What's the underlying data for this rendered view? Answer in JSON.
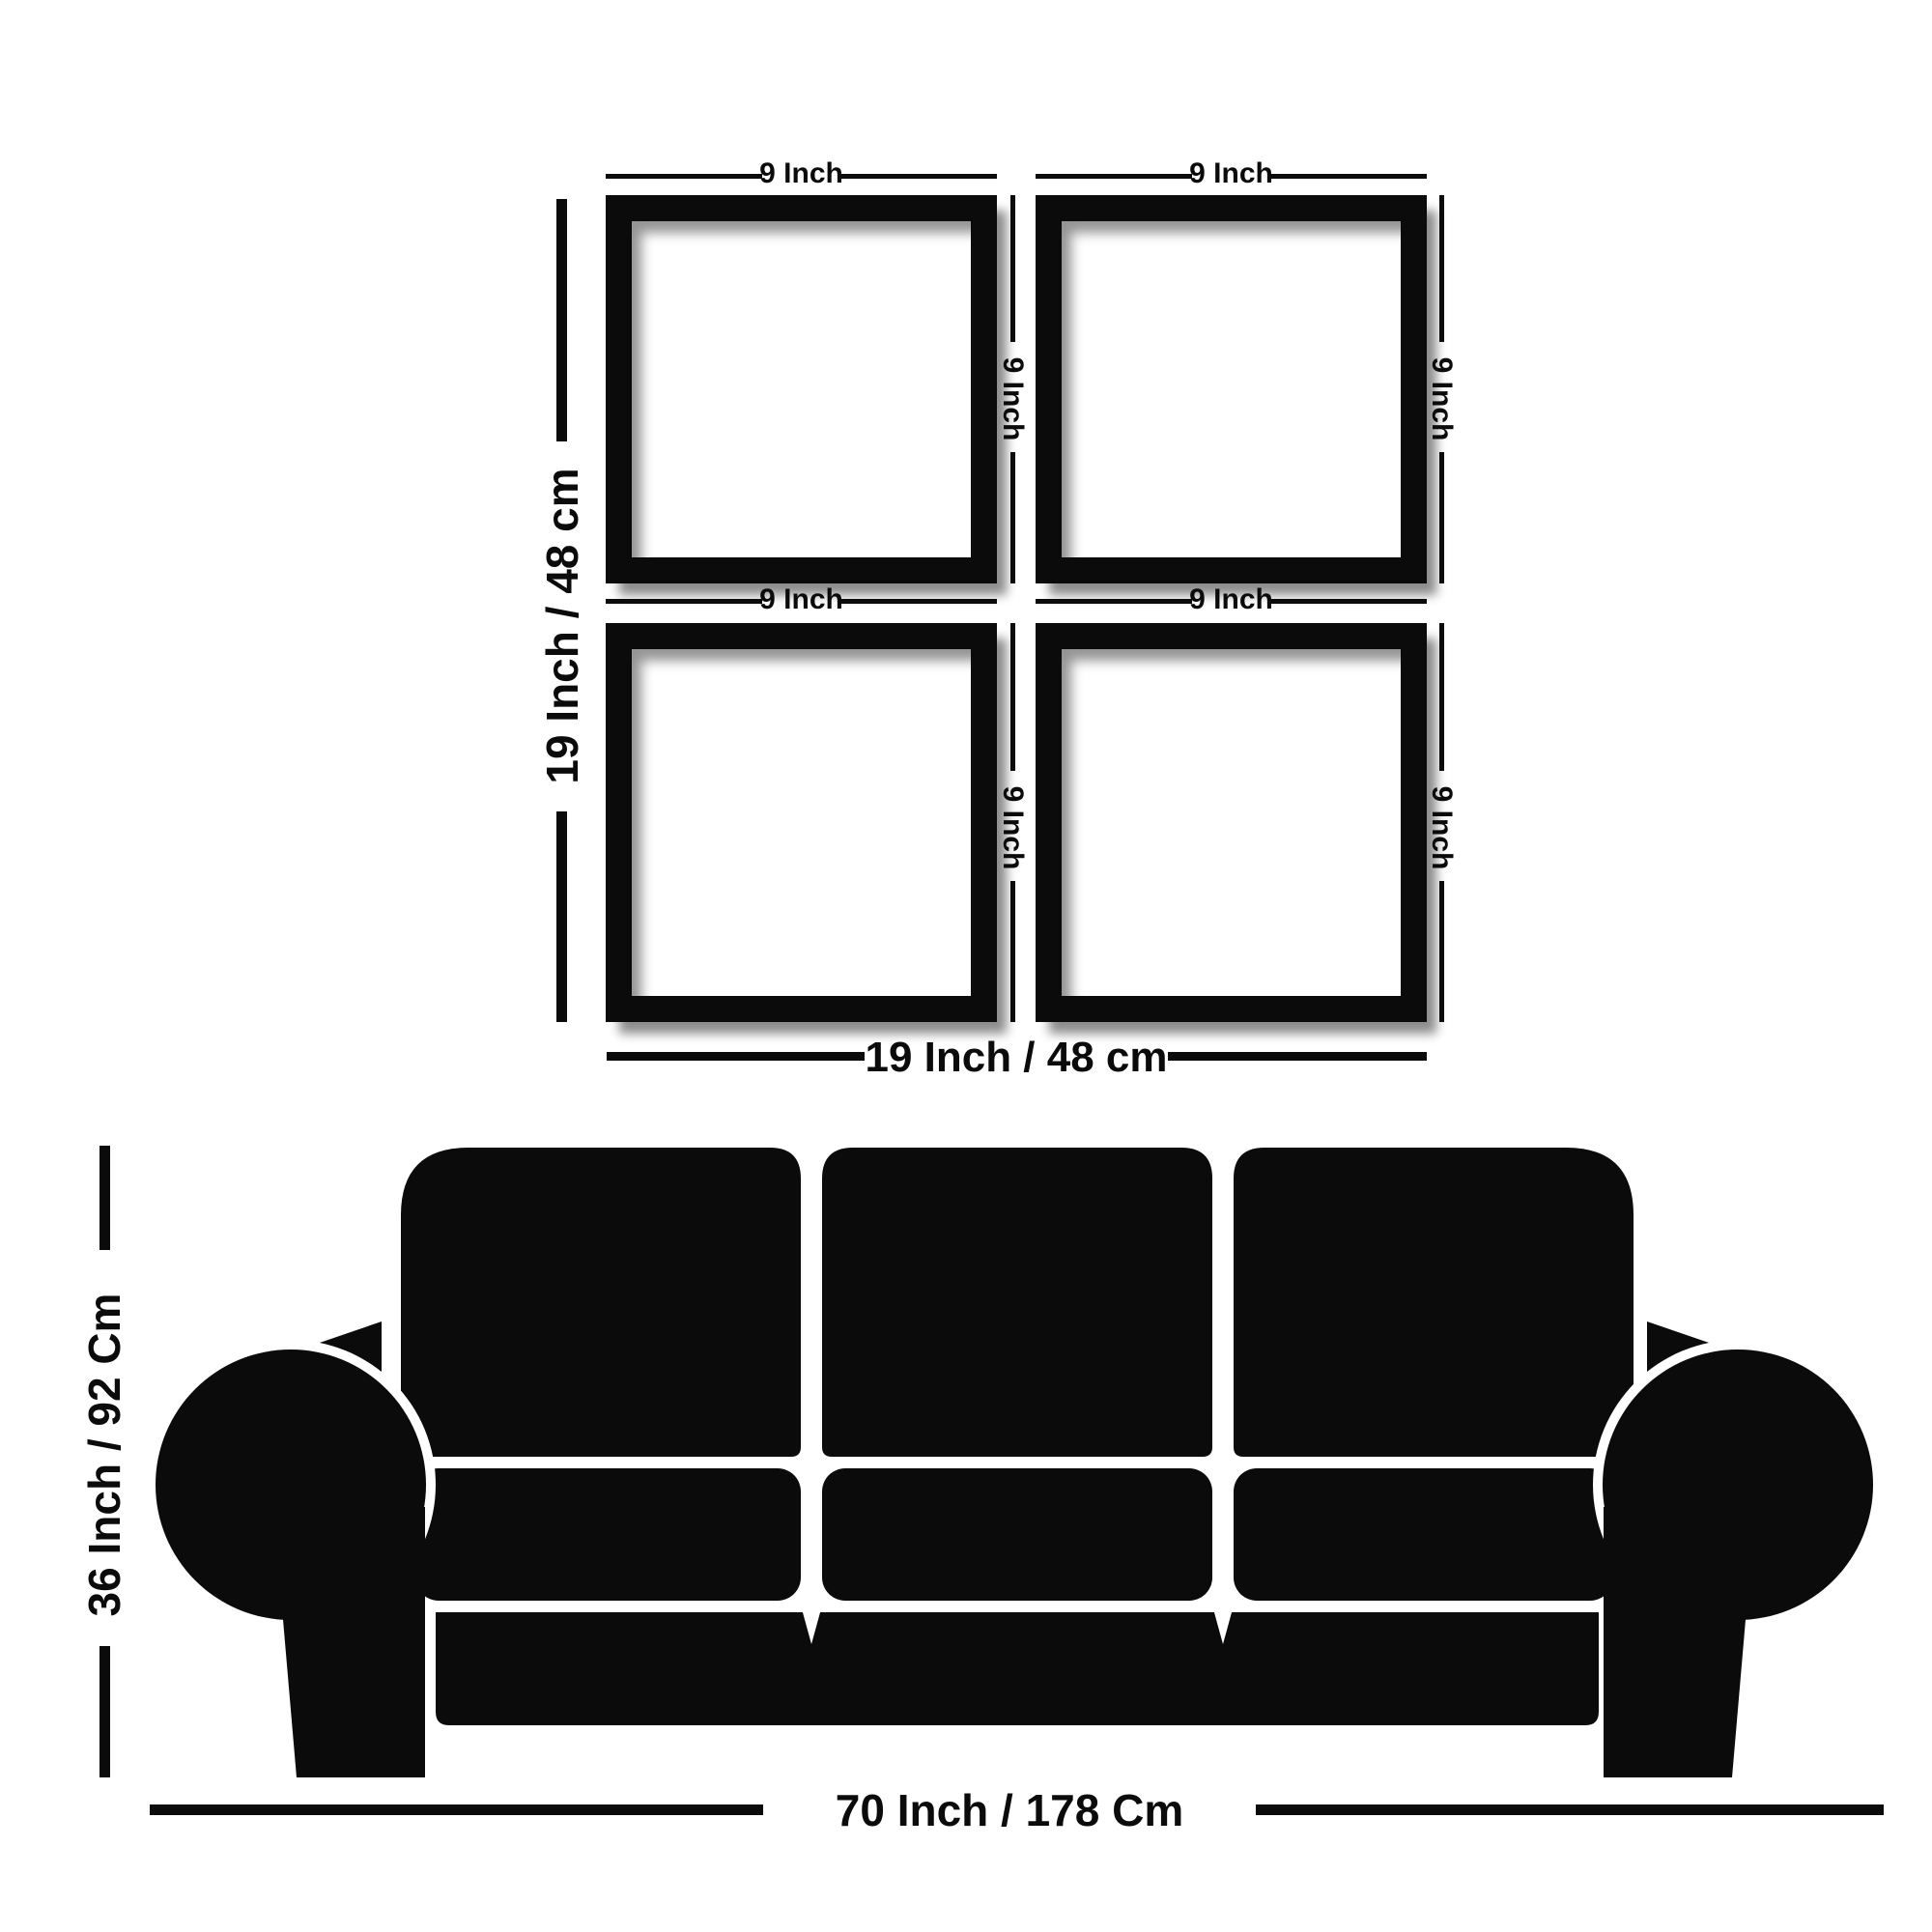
{
  "colors": {
    "ink": "#0b0b0b",
    "background": "#ffffff"
  },
  "frames_diagram": {
    "frame_width_label": "9 Inch",
    "frame_height_label": "9 Inch",
    "grid_height_label": "19 Inch / 48 cm",
    "grid_width_label": "19 Inch / 48 cm",
    "frame_count": 4
  },
  "sofa_diagram": {
    "sofa_height_label": "36 Inch / 92 Cm",
    "sofa_width_label": "70 Inch / 178 Cm"
  }
}
